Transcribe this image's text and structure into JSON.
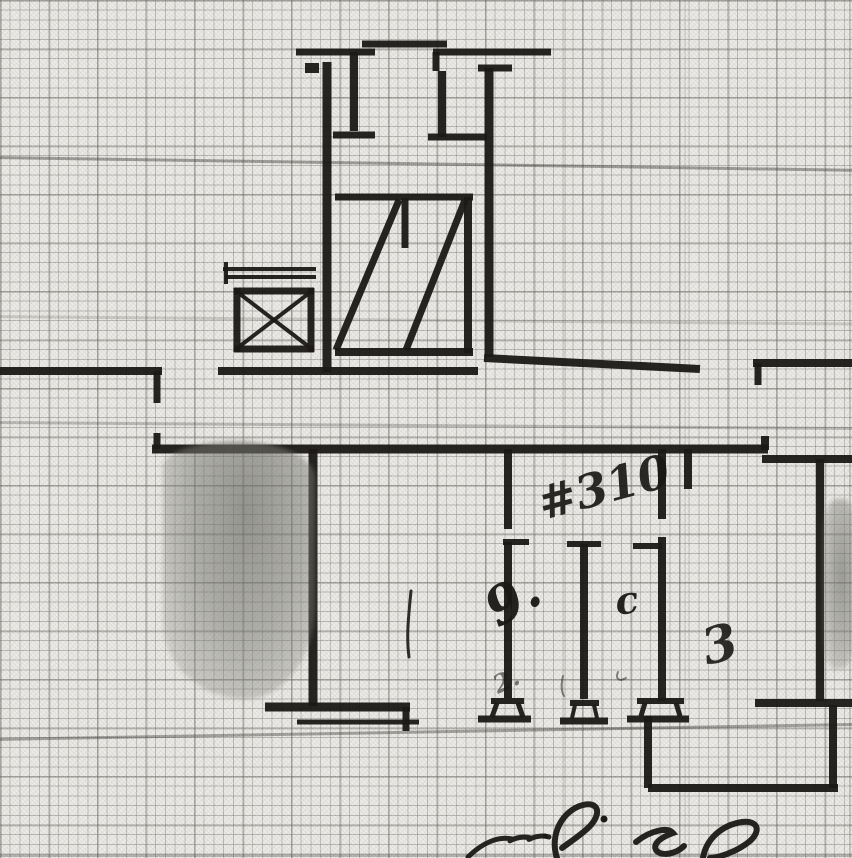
{
  "palette": {
    "paper": "#eae9e5",
    "grid_minor": "#9a9a94",
    "grid_major": "#6f6f68",
    "ink": "#1b1916",
    "smudge": "#8e8e88",
    "ruling_accent": "#32322e"
  },
  "annotations": {
    "items": [
      {
        "text": "#310",
        "x": 543,
        "y": 520,
        "size": 46,
        "rotate": -15,
        "opacity": 0.92
      },
      {
        "text": "9.",
        "x": 498,
        "y": 628,
        "size": 52,
        "rotate": -30,
        "opacity": 0.95
      },
      {
        "text": "c",
        "x": 617,
        "y": 615,
        "size": 38,
        "rotate": -8,
        "opacity": 0.95
      },
      {
        "text": "3",
        "x": 707,
        "y": 665,
        "size": 50,
        "rotate": -14,
        "opacity": 0.9
      },
      {
        "text": "2.",
        "x": 498,
        "y": 694,
        "size": 25,
        "rotate": -25,
        "opacity": 0.55
      }
    ]
  },
  "plan": {
    "segments": [
      [
        362,
        44,
        447,
        44,
        7
      ],
      [
        296,
        52,
        375,
        52,
        7
      ],
      [
        433,
        52,
        551,
        52,
        7
      ],
      [
        354,
        52,
        354,
        131,
        8
      ],
      [
        333,
        135,
        375,
        135,
        7
      ],
      [
        305,
        68,
        319,
        68,
        10
      ],
      [
        327,
        62,
        327,
        372,
        9
      ],
      [
        436,
        52,
        436,
        71,
        7
      ],
      [
        442,
        71,
        442,
        137,
        8
      ],
      [
        428,
        137,
        487,
        137,
        7
      ],
      [
        478,
        68,
        512,
        68,
        7
      ],
      [
        489,
        68,
        489,
        357,
        9
      ],
      [
        335,
        197,
        473,
        197,
        7
      ],
      [
        468,
        197,
        468,
        353,
        8
      ],
      [
        405,
        198,
        405,
        248,
        7
      ],
      [
        335,
        352,
        473,
        352,
        8
      ],
      [
        336,
        350,
        399,
        200,
        7
      ],
      [
        406,
        350,
        465,
        200,
        7
      ],
      [
        223,
        269,
        316,
        269,
        4
      ],
      [
        225,
        277,
        316,
        277,
        4
      ],
      [
        226,
        262,
        226,
        284,
        4
      ],
      [
        234,
        291,
        314,
        291,
        7
      ],
      [
        237,
        288,
        237,
        352,
        7
      ],
      [
        311,
        288,
        311,
        352,
        7
      ],
      [
        234,
        349,
        314,
        349,
        7
      ],
      [
        240,
        294,
        308,
        346,
        4
      ],
      [
        308,
        294,
        240,
        346,
        4
      ],
      [
        0,
        371,
        162,
        371,
        8
      ],
      [
        157,
        371,
        157,
        403,
        7
      ],
      [
        157,
        433,
        157,
        449,
        7
      ],
      [
        218,
        371,
        478,
        371,
        8
      ],
      [
        484,
        358,
        700,
        369,
        8
      ],
      [
        753,
        363,
        852,
        363,
        8
      ],
      [
        758,
        363,
        758,
        385,
        7
      ],
      [
        152,
        449,
        768,
        449,
        9
      ],
      [
        765,
        436,
        765,
        450,
        8
      ],
      [
        762,
        459,
        852,
        459,
        8
      ],
      [
        820,
        459,
        820,
        701,
        8
      ],
      [
        688,
        449,
        688,
        489,
        8
      ],
      [
        313,
        449,
        313,
        706,
        9
      ],
      [
        265,
        707,
        410,
        707,
        9
      ],
      [
        406,
        707,
        406,
        731,
        7
      ],
      [
        297,
        722,
        419,
        722,
        5
      ],
      [
        508,
        449,
        508,
        529,
        8
      ],
      [
        503,
        542,
        529,
        542,
        6
      ],
      [
        508,
        542,
        508,
        698,
        8
      ],
      [
        567,
        544,
        601,
        544,
        6
      ],
      [
        584,
        544,
        584,
        699,
        8
      ],
      [
        662,
        449,
        662,
        519,
        8
      ],
      [
        633,
        546,
        662,
        546,
        6
      ],
      [
        662,
        537,
        662,
        701,
        8
      ],
      [
        491,
        701,
        524,
        701,
        6
      ],
      [
        497,
        703,
        492,
        717,
        5
      ],
      [
        518,
        703,
        523,
        717,
        5
      ],
      [
        478,
        719,
        531,
        719,
        7
      ],
      [
        570,
        703,
        599,
        703,
        6
      ],
      [
        575,
        705,
        572,
        718,
        4
      ],
      [
        594,
        705,
        597,
        718,
        4
      ],
      [
        560,
        721,
        608,
        721,
        7
      ],
      [
        637,
        701,
        684,
        701,
        6
      ],
      [
        645,
        703,
        641,
        716,
        5
      ],
      [
        676,
        703,
        680,
        716,
        5
      ],
      [
        627,
        719,
        689,
        719,
        7
      ],
      [
        755,
        703,
        852,
        703,
        8
      ],
      [
        648,
        716,
        648,
        788,
        8
      ],
      [
        648,
        788,
        838,
        788,
        8
      ],
      [
        833,
        705,
        833,
        788,
        8
      ]
    ],
    "pen_paths": [
      {
        "d": "M411 591 C409 612 406 636 409 657",
        "w": 3,
        "o": 0.9
      },
      {
        "d": "M563 676 C561 684 561 691 564 696",
        "w": 2,
        "o": 0.5
      },
      {
        "d": "M618 672 C615 679 619 682 626 678",
        "w": 2,
        "o": 0.5
      }
    ],
    "signature": {
      "paths": [
        {
          "d": "M468 857 C482 843 498 836 512 839 C505 845 516 834 531 838 C524 843 536 833 549 837",
          "w": 5,
          "o": 0.95
        },
        {
          "d": "M557 858 C549 834 563 810 583 805 C599 801 602 814 589 827 C581 835 570 842 562 848",
          "w": 6,
          "o": 0.95
        },
        {
          "d": "M636 842 C651 830 668 827 673 833 C665 836 652 842 656 850 C661 857 676 854 684 846",
          "w": 6,
          "o": 0.95
        },
        {
          "d": "M703 858 C706 839 722 825 742 822 C757 820 762 830 750 841 C737 852 717 858 710 858",
          "w": 6,
          "o": 0.95
        }
      ],
      "dots": [
        [
          604,
          819,
          3.5
        ],
        [
          545,
          836,
          2.5
        ]
      ]
    }
  },
  "paper": {
    "accent_rows": [
      {
        "y": 156,
        "o": 0.45,
        "rot": 0.85
      },
      {
        "y": 315,
        "o": 0.18,
        "rot": 0.5
      },
      {
        "y": 421,
        "o": 0.28,
        "rot": 0.4
      },
      {
        "y": 738,
        "o": 0.42,
        "rot": -1.0
      },
      {
        "y": 854,
        "o": 0.3,
        "rot": 0
      }
    ],
    "accent_cols": [
      {
        "x": 564,
        "o": 0.14
      },
      {
        "x": 602,
        "o": 0.11
      },
      {
        "x": 684,
        "o": 0.11
      },
      {
        "x": 849,
        "o": 0.22
      }
    ]
  }
}
